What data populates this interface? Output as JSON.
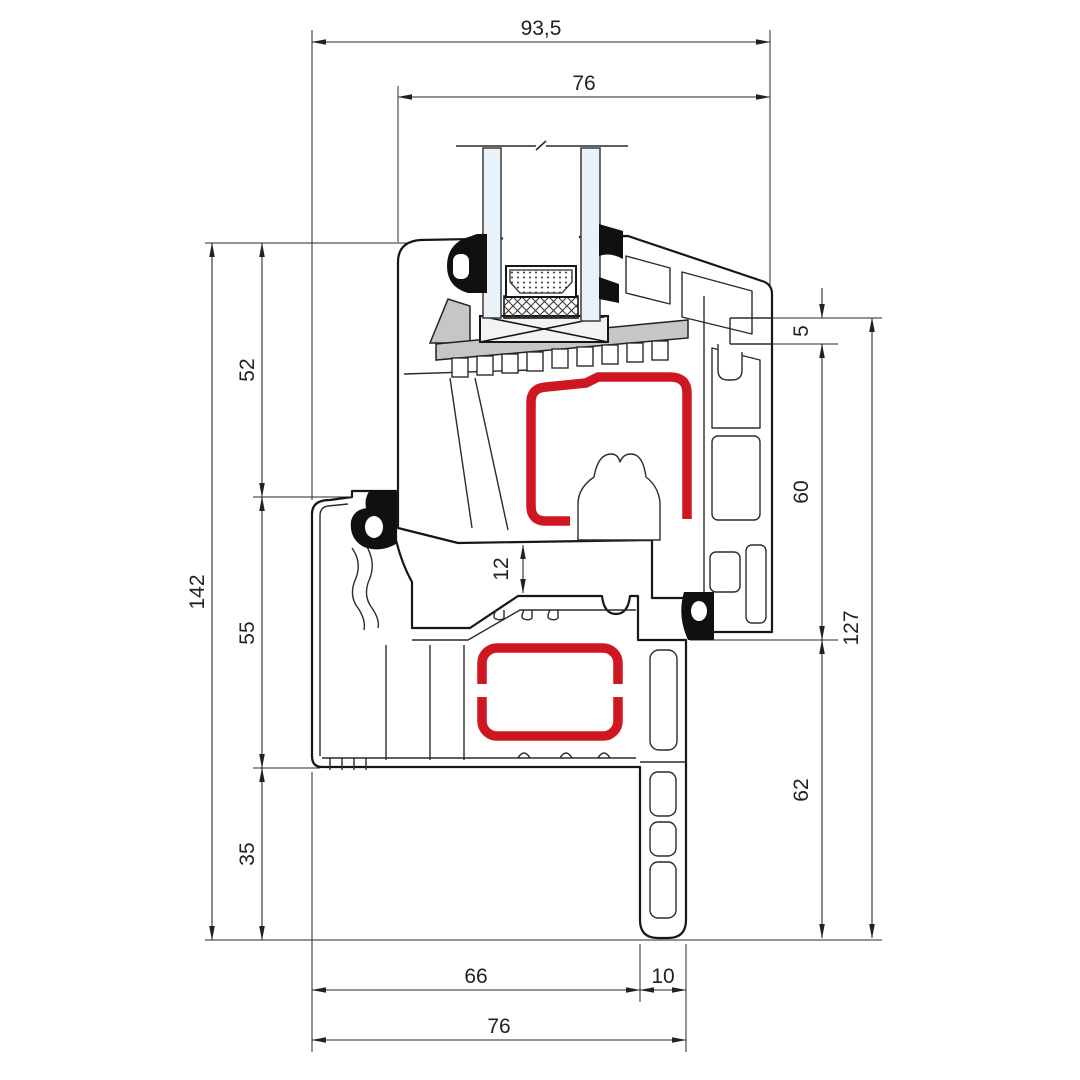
{
  "drawing": {
    "type": "window-profile-cross-section",
    "description": "PVC window sash and frame section with steel reinforcement, glazing unit and dimension chains (mm)"
  },
  "colors": {
    "red": "#cf1721",
    "gray": "#c6c6c6",
    "glass": "#e9f2f9",
    "line": "#1c1c1c",
    "xblock": "#f3f3f3"
  },
  "dims": {
    "top_outer": "93,5",
    "top_inner": "76",
    "left_total": "142",
    "left_sash": "52",
    "left_frame": "55",
    "left_below": "35",
    "middle_gap": "12",
    "right_lip": "5",
    "right_sash": "60",
    "right_total": "127",
    "right_lower": "62",
    "bottom_frame": "66",
    "bottom_fin": "10",
    "bottom_total": "76"
  }
}
